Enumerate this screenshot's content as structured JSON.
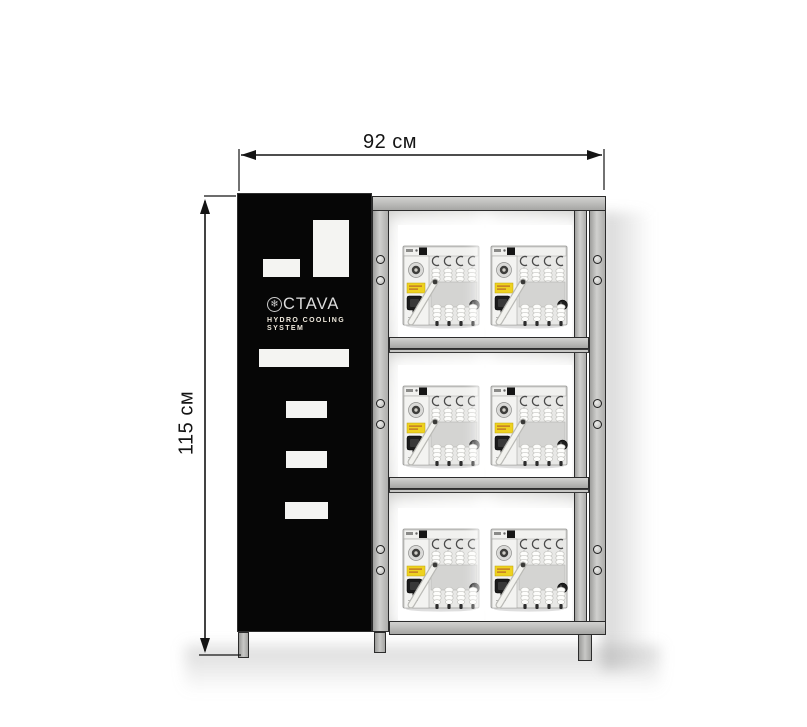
{
  "annotations": {
    "width_label": "92 см",
    "height_label": "115 см"
  },
  "cabinet": {
    "logo": {
      "icon": {
        "name": "snowflake-icon",
        "glyph": "❄"
      },
      "brand_text": "CTAVA",
      "subtitle_line1": "HYDRO COOLING",
      "subtitle_line2": "SYSTEM"
    }
  },
  "rack": {
    "rows": 3,
    "units_per_row": 2
  },
  "colors": {
    "panel_black": "#060606",
    "frame_gray": "#b9b9b7",
    "frame_edge": "#2c2c2c",
    "dimension_line": "#141414",
    "logo_text": "#d9d9d9",
    "cutout_white": "#f4f4f2"
  }
}
